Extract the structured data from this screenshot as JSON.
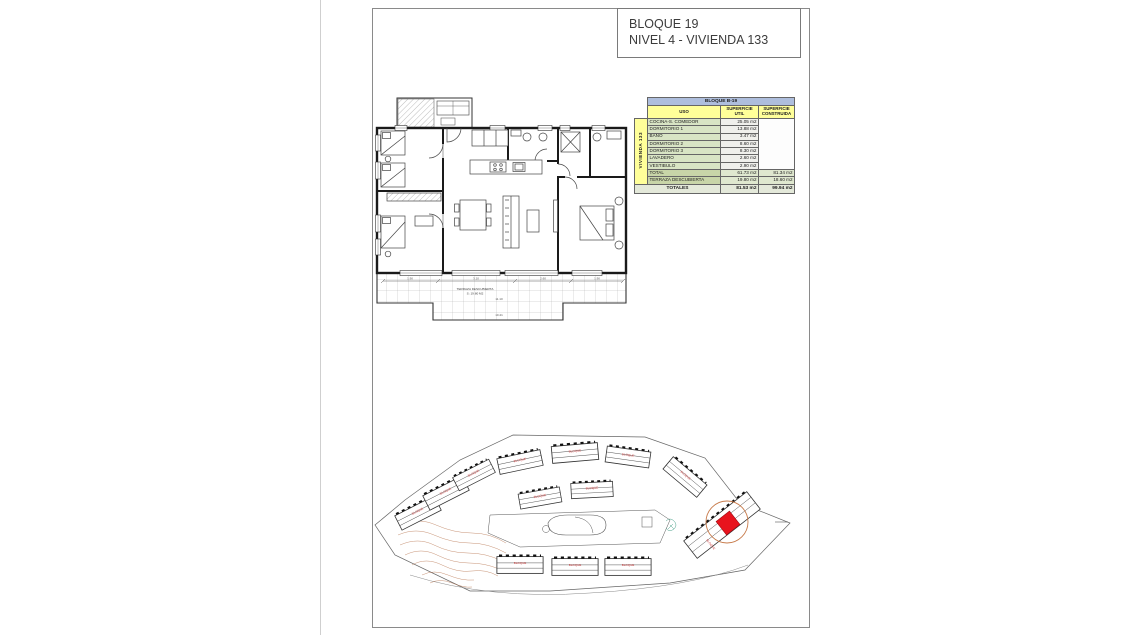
{
  "title_block": {
    "line1": "BLOQUE 19",
    "line2": "NIVEL 4 - VIVIENDA 133"
  },
  "area_table": {
    "block_header": "BLOQUE B-19",
    "vivienda_label": "VIVIENDA 133",
    "col_uso": "USO",
    "col_util": "SUPERFICIE UTIL",
    "col_construida": "SUPERFICIE CONSTRUIDA",
    "rows": [
      {
        "uso": "COCINA-S. COMEDOR",
        "util": "25.05 m2"
      },
      {
        "uso": "DORMITORIO 1",
        "util": "13.88 m2"
      },
      {
        "uso": "BAÑO",
        "util": "3.47 m2"
      },
      {
        "uso": "DORMITORIO 2",
        "util": "8.60 m2"
      },
      {
        "uso": "DORMITORIO 3",
        "util": "8.30 m2"
      },
      {
        "uso": "LAVADERO",
        "util": "2.60 m2"
      },
      {
        "uso": "VESTIBULO",
        "util": "2.90 m2"
      }
    ],
    "total_row": {
      "uso": "TOTAL",
      "util": "61.73 m2",
      "construida": "81.34 m2"
    },
    "terraza_row": {
      "uso": "TERRAZA DESCUBIERTA",
      "util": "19.80 m2",
      "construida": "18.60 m2"
    },
    "totales": {
      "label": "TOTALES",
      "util": "81.53 m2",
      "construida": "99.94 m2"
    },
    "colors": {
      "header_blue": "#aebedd",
      "header_yellow": "#ffff99",
      "row_green": "#d8e4c4",
      "total_green": "#c8d5a8",
      "totales_bg": "#e4e9da"
    }
  },
  "floor_plan": {
    "terrace_label": "TERRAZA DESCUBIERTA",
    "terrace_area": "S: 19.80 M2",
    "dim_1": "1.90",
    "dim_2": "3.10",
    "dim_3": "2.60",
    "dim_4": "1.90",
    "dim_total": "11.10",
    "dim_terrace": "10.41"
  },
  "site_plan": {
    "block_label": "BLOQUE",
    "colors": {
      "highlight_red": "#e8131d",
      "highlight_circle": "#c77a4a",
      "contour_brown": "#b5714a",
      "label_red": "#cc3a3a"
    }
  }
}
